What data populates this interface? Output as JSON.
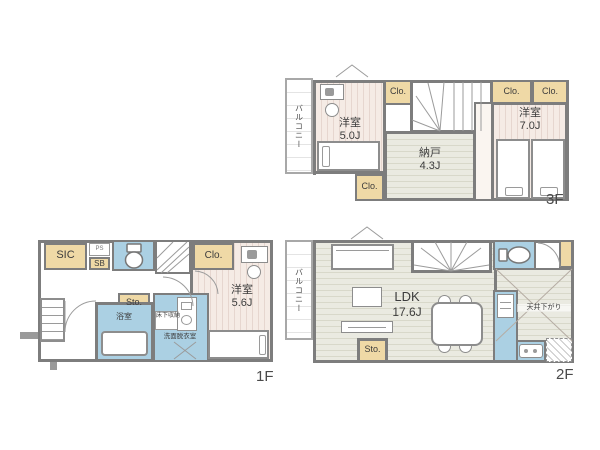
{
  "title": "3-story house floor plan",
  "colors": {
    "closet_fill": "#efd9a6",
    "wet_area_fill": "#abd0e3",
    "wall": "#7d7d7d",
    "bedroom_floor": "#f5ebe5",
    "wood_floor": "#eaeae1"
  },
  "labels": {
    "closet": "Clo.",
    "storage": "Sto.",
    "balcony": "バルコニー",
    "shoe_in_closet": "SIC",
    "shoe_box": "SB",
    "pipe_space": "PS"
  },
  "floor3": {
    "floor_label": "3F",
    "room_west": {
      "name": "洋室",
      "area": "5.0J"
    },
    "storage_room": {
      "name": "納戸",
      "area": "4.3J"
    },
    "room_east": {
      "name": "洋室",
      "area": "7.0J"
    }
  },
  "floor2": {
    "floor_label": "2F",
    "ldk_name": "LDK",
    "ldk_area": "17.6J",
    "ceiling_note": "天井下がり"
  },
  "floor1": {
    "floor_label": "1F",
    "room": {
      "name": "洋室",
      "area": "5.6J"
    },
    "bathroom": "浴室",
    "underfloor_storage": "床下収納",
    "washroom": "洗面脱衣室"
  }
}
